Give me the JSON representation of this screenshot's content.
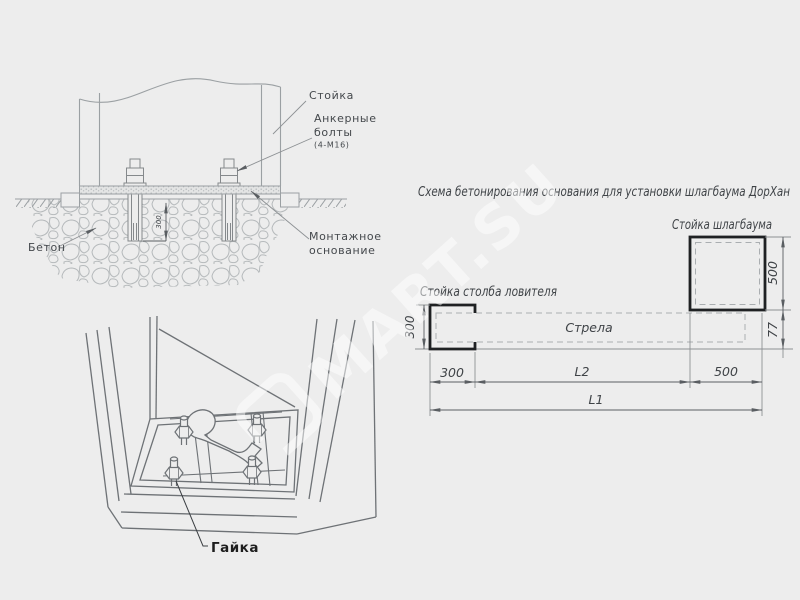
{
  "title": "Схема бетонирования основания для установки шлагбаума ДорХан",
  "section_view": {
    "post_label": "Стойка",
    "anchor_bolts_label_line1": "Анкерные",
    "anchor_bolts_label_line2": "болты",
    "anchor_bolts_spec": "(4-М16)",
    "concrete_label": "Бетон",
    "mounting_base_label_line1": "Монтажное",
    "mounting_base_label_line2": "основание",
    "embed_depth_dim": "300"
  },
  "nut_view": {
    "nut_label": "Гайка"
  },
  "plan_view": {
    "barrier_post_label": "Стойка шлагбаума",
    "catcher_post_label": "Стойка столба ловителя",
    "boom_label": "Стрела",
    "dim_catcher_height": "300",
    "dim_catcher_width": "300",
    "dim_barrier_height": "500",
    "dim_boom_offset": "77",
    "dim_l2": "L2",
    "dim_barrier_width": "500",
    "dim_l1": "L1"
  },
  "watermark": {
    "brand": "MART.SU"
  },
  "colors": {
    "background": "#ededed",
    "thin_line": "#9ba0a3",
    "medium_line": "#6e7276",
    "thick_line": "#1f2123",
    "text": "#3f4347",
    "watermark": "#ffffff"
  }
}
